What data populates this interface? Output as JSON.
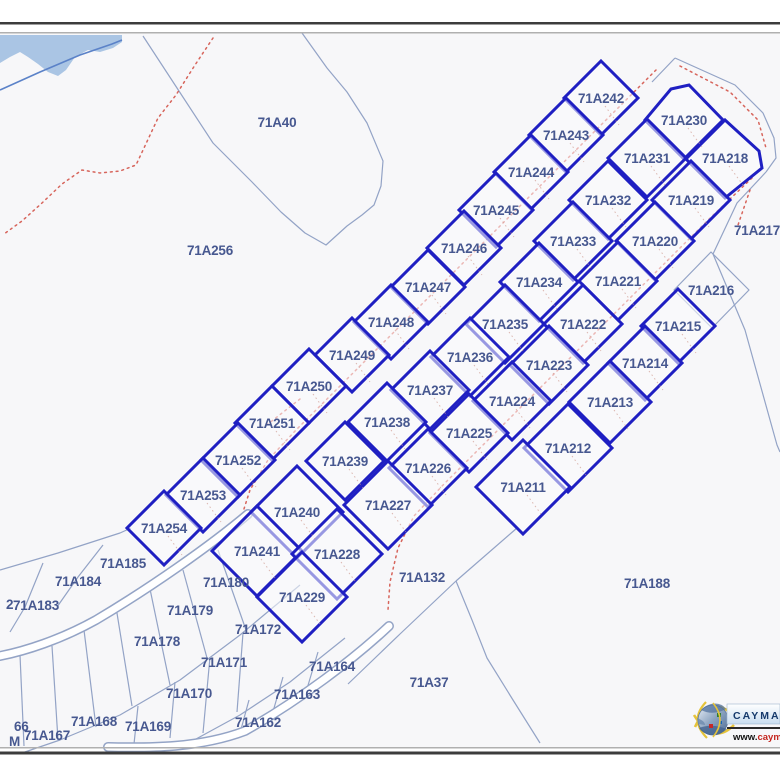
{
  "page": {
    "background": "#ffffff",
    "map_background": "#f7f7f9"
  },
  "colors": {
    "bold_parcel": "#1f1fc2",
    "thin_line": "#93a3c6",
    "label": "#475890",
    "road_dots": "#d14b41",
    "leader_dots": "#cf9a8e",
    "water_fill": "#aac5e4",
    "water_line": "#5b82c8",
    "road_casing": "#94a4c6",
    "road_fill": "#ffffff",
    "frame_dark": "#3c3c3c",
    "frame_light": "#b0b0b0",
    "logo_navy": "#15396b",
    "logo_red": "#c4251e"
  },
  "map": {
    "parcels_bold": [
      {
        "id": "71A242",
        "x": 601,
        "y": 98
      },
      {
        "id": "71A243",
        "x": 566,
        "y": 135
      },
      {
        "id": "71A244",
        "x": 531,
        "y": 172
      },
      {
        "id": "71A245",
        "x": 496,
        "y": 210
      },
      {
        "id": "71A246",
        "x": 464,
        "y": 248
      },
      {
        "id": "71A247",
        "x": 428,
        "y": 287
      },
      {
        "id": "71A248",
        "x": 391,
        "y": 322
      },
      {
        "id": "71A249",
        "x": 352,
        "y": 355
      },
      {
        "id": "71A250",
        "x": 309,
        "y": 386
      },
      {
        "id": "71A251",
        "x": 272,
        "y": 423
      },
      {
        "id": "71A252",
        "x": 238,
        "y": 460
      },
      {
        "id": "71A253",
        "x": 203,
        "y": 495
      },
      {
        "id": "71A254",
        "x": 164,
        "y": 528
      },
      {
        "id": "71A230",
        "x": 684,
        "y": 120
      },
      {
        "id": "71A231",
        "x": 647,
        "y": 158
      },
      {
        "id": "71A232",
        "x": 608,
        "y": 200
      },
      {
        "id": "71A233",
        "x": 573,
        "y": 241
      },
      {
        "id": "71A234",
        "x": 539,
        "y": 282
      },
      {
        "id": "71A235",
        "x": 505,
        "y": 324
      },
      {
        "id": "71A236",
        "x": 470,
        "y": 357
      },
      {
        "id": "71A237",
        "x": 430,
        "y": 390
      },
      {
        "id": "71A238",
        "x": 387,
        "y": 422
      },
      {
        "id": "71A239",
        "x": 345,
        "y": 461
      },
      {
        "id": "71A240",
        "x": 297,
        "y": 512
      },
      {
        "id": "71A241",
        "x": 257,
        "y": 551
      },
      {
        "id": "71A218",
        "x": 725,
        "y": 158
      },
      {
        "id": "71A219",
        "x": 691,
        "y": 200
      },
      {
        "id": "71A220",
        "x": 655,
        "y": 241
      },
      {
        "id": "71A221",
        "x": 618,
        "y": 281
      },
      {
        "id": "71A222",
        "x": 583,
        "y": 324
      },
      {
        "id": "71A223",
        "x": 549,
        "y": 365
      },
      {
        "id": "71A224",
        "x": 512,
        "y": 401
      },
      {
        "id": "71A225",
        "x": 469,
        "y": 433
      },
      {
        "id": "71A226",
        "x": 428,
        "y": 468
      },
      {
        "id": "71A227",
        "x": 388,
        "y": 505
      },
      {
        "id": "71A228",
        "x": 337,
        "y": 554
      },
      {
        "id": "71A229",
        "x": 302,
        "y": 597
      },
      {
        "id": "71A215",
        "x": 678,
        "y": 326
      },
      {
        "id": "71A214",
        "x": 645,
        "y": 363
      },
      {
        "id": "71A213",
        "x": 610,
        "y": 402
      },
      {
        "id": "71A212",
        "x": 568,
        "y": 448
      },
      {
        "id": "71A211",
        "x": 523,
        "y": 487
      }
    ],
    "parcels_thin": [
      {
        "id": "71A40",
        "x": 277,
        "y": 122
      },
      {
        "id": "71A256",
        "x": 210,
        "y": 250
      },
      {
        "id": "71A216",
        "x": 711,
        "y": 290
      },
      {
        "id": "71A217",
        "x": 757,
        "y": 230
      },
      {
        "id": "71A132",
        "x": 422,
        "y": 577
      },
      {
        "id": "71A188",
        "x": 647,
        "y": 583
      },
      {
        "id": "71A37",
        "x": 429,
        "y": 682
      },
      {
        "id": "71A185",
        "x": 123,
        "y": 563
      },
      {
        "id": "71A184",
        "x": 78,
        "y": 581
      },
      {
        "id": "71A183",
        "x": 36,
        "y": 605
      },
      {
        "id": "71A180",
        "x": 226,
        "y": 582
      },
      {
        "id": "71A179",
        "x": 190,
        "y": 610
      },
      {
        "id": "71A178",
        "x": 157,
        "y": 641
      },
      {
        "id": "71A172",
        "x": 258,
        "y": 629
      },
      {
        "id": "71A171",
        "x": 224,
        "y": 662
      },
      {
        "id": "71A170",
        "x": 189,
        "y": 693
      },
      {
        "id": "71A164",
        "x": 332,
        "y": 666
      },
      {
        "id": "71A163",
        "x": 297,
        "y": 694
      },
      {
        "id": "71A162",
        "x": 258,
        "y": 722
      },
      {
        "id": "71A169",
        "x": 148,
        "y": 726
      },
      {
        "id": "71A168",
        "x": 94,
        "y": 721
      },
      {
        "id": "71A167",
        "x": 47,
        "y": 735
      }
    ],
    "fragments": [
      {
        "id": "2",
        "x": 6,
        "y": 604
      },
      {
        "id": "66",
        "x": 14,
        "y": 726
      },
      {
        "id": "M",
        "x": 9,
        "y": 741
      }
    ]
  },
  "logo": {
    "brand": "CAYMAN",
    "url_prefix": "www.",
    "url_rest": "caym"
  }
}
